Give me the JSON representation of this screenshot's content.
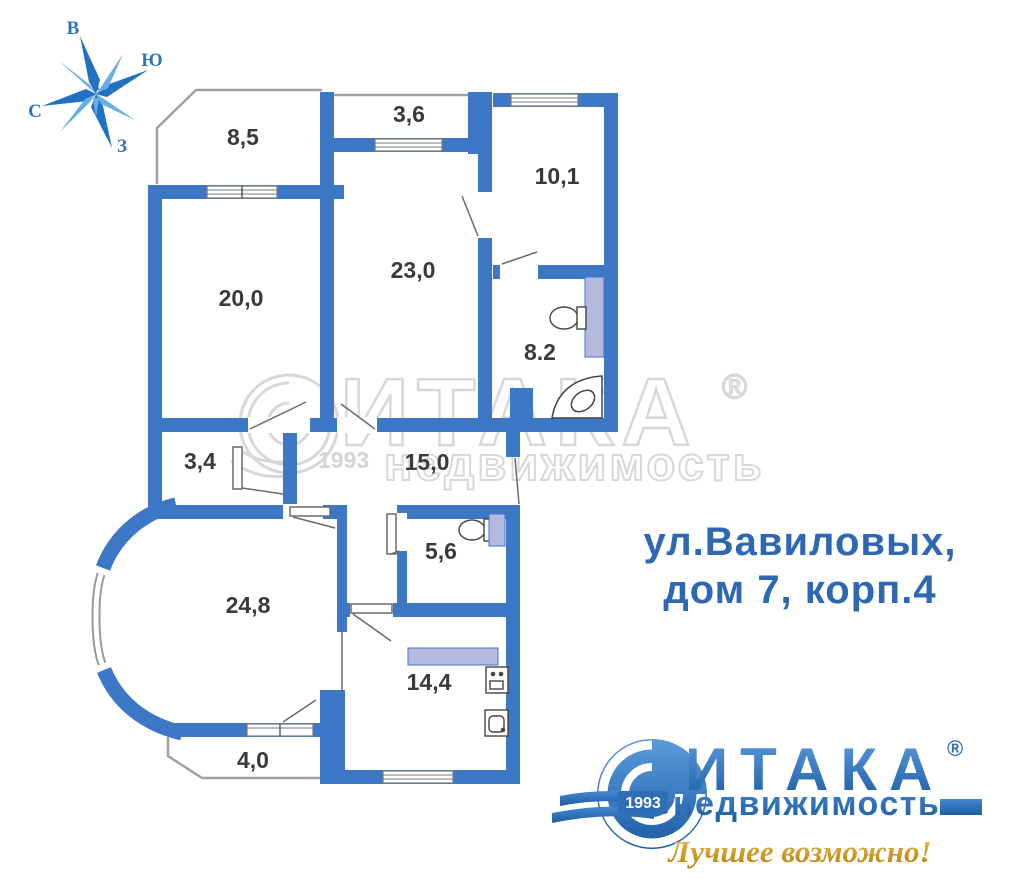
{
  "compass": {
    "east": "В",
    "south": "Ю",
    "north": "С",
    "west": "З"
  },
  "rooms": [
    {
      "id": "balcony-top-left",
      "area": "8,5"
    },
    {
      "id": "balcony-top",
      "area": "3,6"
    },
    {
      "id": "room-top-right",
      "area": "10,1"
    },
    {
      "id": "room-left",
      "area": "20,0"
    },
    {
      "id": "room-center",
      "area": "23,0"
    },
    {
      "id": "bathroom",
      "area": "8.2"
    },
    {
      "id": "closet",
      "area": "3,4"
    },
    {
      "id": "hallway",
      "area": "15,0"
    },
    {
      "id": "wc",
      "area": "5,6"
    },
    {
      "id": "living-room",
      "area": "24,8"
    },
    {
      "id": "kitchen",
      "area": "14,4"
    },
    {
      "id": "balcony-bottom",
      "area": "4,0"
    }
  ],
  "address": {
    "line1": "ул.Вавиловых,",
    "line2": "дом 7, корп.4"
  },
  "watermark": {
    "brand": "ИТАКА",
    "reg": "®",
    "subtitle": "недвижимость",
    "year": "1993"
  },
  "logo": {
    "brand": "ИТАКА",
    "reg": "®",
    "subtitle": "недвижимость",
    "year": "1993",
    "tagline": "Лучшее возможно!"
  },
  "colors": {
    "wall": "#3d78c6",
    "fixture": "#b4badf",
    "address_blue": "#2e68b3",
    "logo_blue": "#2f6db6",
    "tagline_gold": "#c8920a",
    "watermark_gray": "#d8d8d8"
  }
}
